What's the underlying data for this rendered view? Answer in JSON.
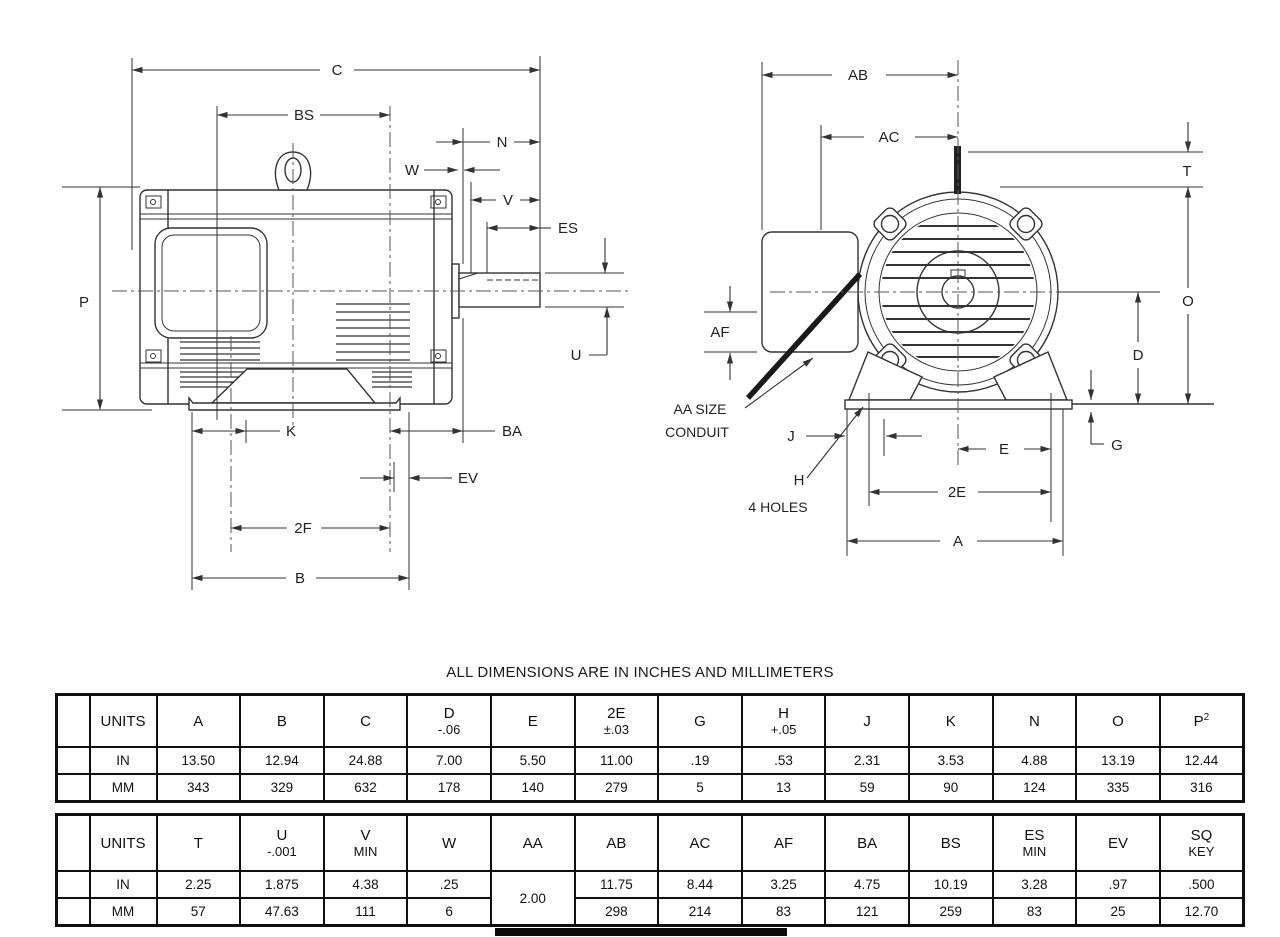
{
  "note": "ALL DIMENSIONS ARE IN INCHES AND MILLIMETERS",
  "drawing": {
    "side": {
      "c": "C",
      "bs": "BS",
      "n": "N",
      "w": "W",
      "v": "V",
      "es": "ES",
      "p": "P",
      "u": "U",
      "k": "K",
      "ba": "BA",
      "ev": "EV",
      "f2": "2F",
      "b": "B"
    },
    "front": {
      "ab": "AB",
      "ac": "AC",
      "t": "T",
      "o": "O",
      "d": "D",
      "g": "G",
      "e": "E",
      "e2": "2E",
      "a": "A",
      "j": "J",
      "h": "H",
      "af": "AF",
      "aa1": "AA SIZE",
      "aa2": "CONDUIT",
      "holes": "4 HOLES"
    }
  },
  "tables": [
    {
      "name": "table-dimensions-primary",
      "columns": [
        {
          "label": "UNITS"
        },
        {
          "label": "A"
        },
        {
          "label": "B"
        },
        {
          "label": "C"
        },
        {
          "label": "D",
          "sub": "-.06"
        },
        {
          "label": "E"
        },
        {
          "label": "2E",
          "sub": "±.03"
        },
        {
          "label": "G"
        },
        {
          "label": "H",
          "sub": "+.05"
        },
        {
          "label": "J"
        },
        {
          "label": "K"
        },
        {
          "label": "N"
        },
        {
          "label": "O"
        },
        {
          "label": "P",
          "sup": "2"
        }
      ],
      "rows": [
        {
          "unit": "IN",
          "values": [
            "13.50",
            "12.94",
            "24.88",
            "7.00",
            "5.50",
            "11.00",
            ".19",
            ".53",
            "2.31",
            "3.53",
            "4.88",
            "13.19",
            "12.44"
          ]
        },
        {
          "unit": "MM",
          "values": [
            "343",
            "329",
            "632",
            "178",
            "140",
            "279",
            "5",
            "13",
            "59",
            "90",
            "124",
            "335",
            "316"
          ]
        }
      ]
    },
    {
      "name": "table-dimensions-secondary",
      "columns": [
        {
          "label": "UNITS"
        },
        {
          "label": "T"
        },
        {
          "label": "U",
          "sub": "-.001"
        },
        {
          "label": "V",
          "sub": "MIN"
        },
        {
          "label": "W"
        },
        {
          "label": "AA"
        },
        {
          "label": "AB"
        },
        {
          "label": "AC"
        },
        {
          "label": "AF"
        },
        {
          "label": "BA"
        },
        {
          "label": "BS"
        },
        {
          "label": "ES",
          "sub": "MIN"
        },
        {
          "label": "EV"
        },
        {
          "label": "SQ",
          "sub": "KEY"
        }
      ],
      "merge": {
        "col": 4
      },
      "rows": [
        {
          "unit": "IN",
          "values": [
            "2.25",
            "1.875",
            "4.38",
            ".25",
            "2.00",
            "11.75",
            "8.44",
            "3.25",
            "4.75",
            "10.19",
            "3.28",
            ".97",
            ".500"
          ]
        },
        {
          "unit": "MM",
          "values": [
            "57",
            "47.63",
            "111",
            "6",
            "2.00",
            "298",
            "214",
            "83",
            "121",
            "259",
            "83",
            "25",
            "12.70"
          ]
        }
      ]
    }
  ]
}
